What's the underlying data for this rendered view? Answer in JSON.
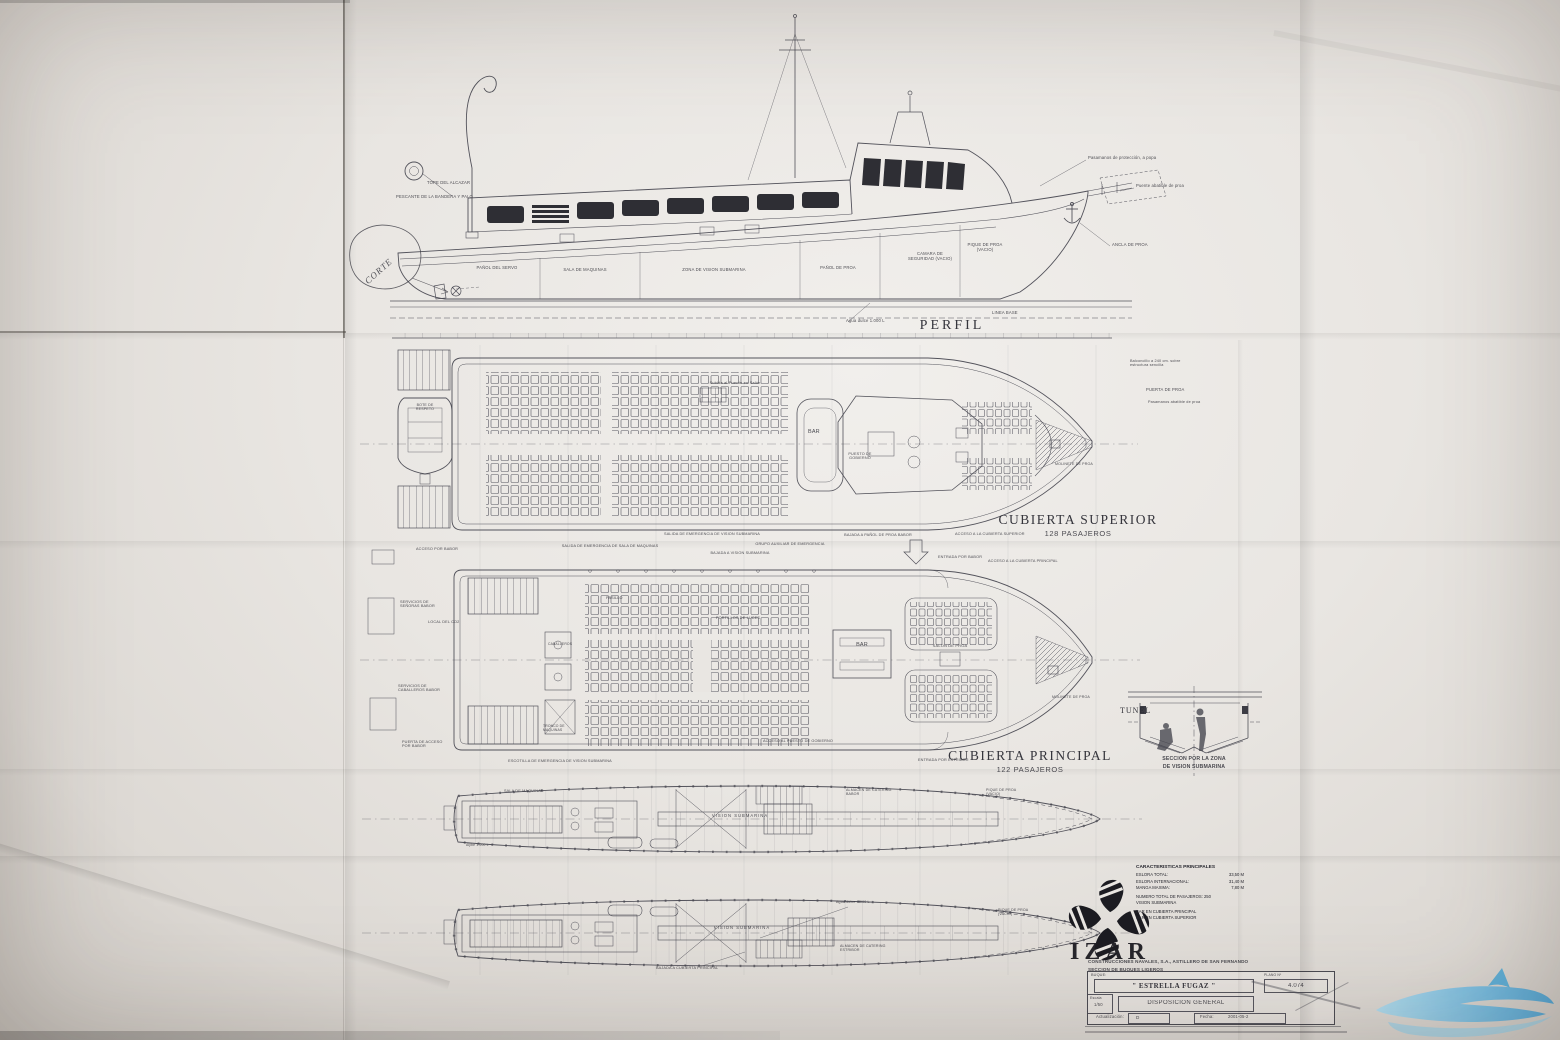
{
  "document": {
    "type": "naval-architecture-general-arrangement-drawing",
    "paper_color": "#e9e6e2",
    "ink_color": "#41414b",
    "accent_blue": "#4aa8d8"
  },
  "labels": {
    "profile": [
      {
        "t": "TOPE DEL ALCAZAR"
      },
      {
        "t": "PESCANTE DE LA BANDERA Y PALO"
      },
      {
        "t": "PAÑOL DEL SERVO"
      },
      {
        "t": "SALA DE MAQUINAS"
      },
      {
        "t": "ZONA DE VISION SUBMARINA"
      },
      {
        "t": "PAÑOL DE PROA"
      },
      {
        "t": "CAMARA DE SEGURIDAD (VACIO)"
      },
      {
        "t": "PIQUE DE PROA (VACIO)"
      },
      {
        "t": "Pasamanos de protección, a popa"
      },
      {
        "t": "Puente abatible de proa"
      },
      {
        "t": "ANCLA DE PROA"
      },
      {
        "t": "Agua dulce 1.000 L"
      },
      {
        "t": "LINEA BASE"
      },
      {
        "t": "PERFIL"
      }
    ],
    "superior": [
      {
        "t": "CUBIERTA SUPERIOR"
      },
      {
        "t": "128 PASAJEROS"
      },
      {
        "t": "BAR"
      },
      {
        "t": "PUESTO DE GOBIERNO"
      },
      {
        "t": "Subida al Puente en Salón"
      },
      {
        "t": "BOTE DE RESPETO"
      },
      {
        "t": "Balconcillo a 240 cm. sobre estructura sencilla"
      },
      {
        "t": "PUERTA DE PROA"
      },
      {
        "t": "Pasamanos abatible de proa"
      },
      {
        "t": "MOLINETE DE PROA"
      },
      {
        "t": "SALIDA DE EMERGENCIA DE SALA DE MAQUINAS"
      },
      {
        "t": "SALIDA DE EMERGENCIA DE VISION SUBMARINA"
      },
      {
        "t": "BAJADA A VISION SUBMARINA"
      },
      {
        "t": "GRUPO AUXILIAR DE EMERGENCIA"
      },
      {
        "t": "BAJADA A PAÑOL DE PROA BABOR"
      },
      {
        "t": "ACCESO A LA CUBIERTA SUPERIOR"
      },
      {
        "t": "ENTRADA POR BABOR"
      }
    ],
    "principal": [
      {
        "t": "CUBIERTA PRINCIPAL"
      },
      {
        "t": "122 PASAJEROS"
      },
      {
        "t": "ACCESO A LA CUBIERTA PRINCIPAL"
      },
      {
        "t": "PASILLO"
      },
      {
        "t": "PORTILLOS DE LUCES"
      },
      {
        "t": "CABALLEROS"
      },
      {
        "t": "TRONCO DE MAQUINAS"
      },
      {
        "t": "BAR"
      },
      {
        "t": "SALON DE PROA"
      },
      {
        "t": "ACCESO AL PUESTO DE GOBIERNO"
      },
      {
        "t": "MOLINETE DE PROA"
      },
      {
        "t": "ACCESO POR BABOR"
      },
      {
        "t": "SERVICIOS DE SEÑORAS BABOR"
      },
      {
        "t": "LOCAL DEL CO2"
      },
      {
        "t": "SERVICIOS DE CABALLEROS BABOR"
      },
      {
        "t": "PUERTA DE ACCESO POR BABOR"
      },
      {
        "t": "ESCOTILLA DE EMERGENCIA DE VISION SUBMARINA"
      },
      {
        "t": "ENTRADA POR ESTRIBOR"
      }
    ],
    "holds": [
      {
        "t": "SALA DE MAQUINAS"
      },
      {
        "t": "VISION SUBMARINA"
      },
      {
        "t": "ALMACEN DE CATERING BABOR"
      },
      {
        "t": "PIQUE DE PROA (VACIO)"
      },
      {
        "t": "Aljibe 1.000 L"
      },
      {
        "t": "VISION SUBMARINA"
      },
      {
        "t": "Agua dulce 1.000 L"
      },
      {
        "t": "ALMACEN DE CATERING ESTRIBOR"
      },
      {
        "t": "PIQUE DE PROA (VACIO)"
      },
      {
        "t": "BAJADA A CUBIERTA PRINCIPAL"
      }
    ],
    "tunel": [
      {
        "t": "TUNEL"
      },
      {
        "t": "SECCION POR LA ZONA"
      },
      {
        "t": "DE VISION SUBMARINA"
      }
    ]
  },
  "characteristics": {
    "title": "CARACTERISTICAS PRINCIPALES",
    "rows": [
      {
        "l": "ESLORA TOTAL:",
        "v": "33,50 M"
      },
      {
        "l": "ESLORA INTERNACIONAL:",
        "v": "31,40 M"
      },
      {
        "l": "MANGA MAXIMA:",
        "v": "7,80 M"
      }
    ],
    "plain": [
      {
        "t": "NUMERO TOTAL DE PASAJEROS:  250"
      },
      {
        "t": "VISION SUBMARINA"
      },
      {
        "t": "BAR EN CUBIERTA PRINCIPAL"
      },
      {
        "t": "BAR EN CUBIERTA SUPERIOR"
      }
    ]
  },
  "company": {
    "logo_text": "IZAR",
    "line1": "CONSTRUCCIONES NAVALES, S.A., ASTILLERO DE SAN FERNANDO",
    "line2": "SECCION DE BUQUES LIGEROS"
  },
  "titleblock": {
    "buque_label": "BUQUE:",
    "ship_name": "\" ESTRELLA FUGAZ \"",
    "plano_label": "PLANO Nº",
    "plano_no": "4.074",
    "escala_label": "Escala",
    "escala_value": "1/50",
    "drawing_title": "DISPOSICION GENERAL",
    "act_label": "Actualización:",
    "act_value": "D",
    "fecha_label": "Fecha:",
    "fecha_value": "2001-05-2"
  },
  "stamp": {
    "t": "CORTE"
  }
}
